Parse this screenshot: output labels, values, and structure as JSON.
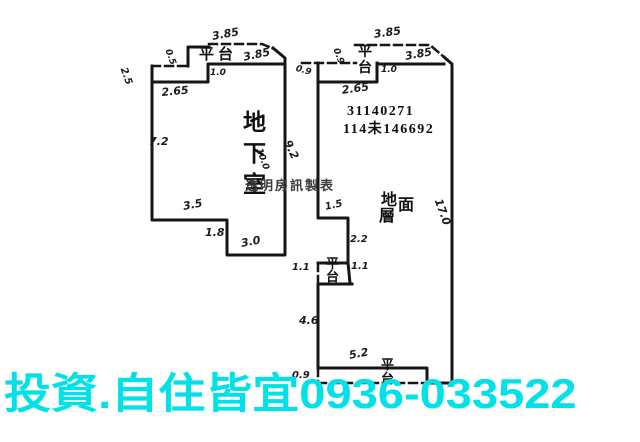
{
  "canvas": {
    "background": "#ffffff",
    "ink_color": "#161616"
  },
  "watermark": {
    "text": "投資.自住皆宜0936-033522",
    "color": "#00e2e8"
  },
  "plan": {
    "left_building_room": "地下室",
    "right_building_room": "地面層",
    "registration_line1": "31140271",
    "registration_line2": "114未146692",
    "maker_credit": "透明房訊製表",
    "platform_label": "平台"
  },
  "annotations": [
    {
      "name": "dim-left-platform-top",
      "text": "3.85",
      "x": 211,
      "y": 30,
      "rot": -10,
      "kind": "dim"
    },
    {
      "name": "left-platform-label",
      "text": "平台",
      "x": 199,
      "y": 43,
      "kind": "room",
      "size": 15,
      "spacing": 4
    },
    {
      "name": "dim-left-top-edge",
      "text": "3.85",
      "x": 242,
      "y": 51,
      "rot": -12,
      "kind": "dim"
    },
    {
      "name": "dim-left-platform-side",
      "text": "0.5",
      "x": 172,
      "y": 48,
      "rot": 70,
      "kind": "dim",
      "size": 9
    },
    {
      "name": "dim-left-upper-left",
      "text": "2.5",
      "x": 128,
      "y": 66,
      "rot": 70,
      "kind": "dim",
      "size": 10
    },
    {
      "name": "dim-left-step",
      "text": "1.0",
      "x": 210,
      "y": 68,
      "kind": "dim",
      "size": 9
    },
    {
      "name": "dim-left-shoulder",
      "text": "2.65",
      "x": 161,
      "y": 86,
      "rot": -5,
      "kind": "dim"
    },
    {
      "name": "dim-left-west-wall",
      "text": "7.2",
      "x": 149,
      "y": 135,
      "kind": "dim"
    },
    {
      "name": "left-room-label",
      "text": "地下室",
      "x": 243,
      "y": 107,
      "dir": "v",
      "size": 23,
      "gap": 8,
      "kind": "room"
    },
    {
      "name": "dim-left-east-wall",
      "text": "10.0",
      "x": 263,
      "y": 147,
      "rot": 70,
      "kind": "dim",
      "size": 9
    },
    {
      "name": "dim-left-bottom-upper",
      "text": "3.5",
      "x": 182,
      "y": 200,
      "rot": -10,
      "kind": "dim"
    },
    {
      "name": "dim-left-bottom-step",
      "text": "1.8",
      "x": 205,
      "y": 226,
      "kind": "dim"
    },
    {
      "name": "dim-left-bottom-lower",
      "text": "3.0",
      "x": 240,
      "y": 237,
      "rot": -10,
      "kind": "dim"
    },
    {
      "name": "maker-credit",
      "text": "透明房訊製表",
      "x": 245,
      "y": 175,
      "kind": "credit"
    },
    {
      "name": "dim-right-platform-top",
      "text": "3.85",
      "x": 373,
      "y": 28,
      "rot": -8,
      "kind": "dim"
    },
    {
      "name": "right-platform-top-label",
      "text": "平台",
      "x": 358,
      "y": 45,
      "dir": "v",
      "size": 14,
      "gap": 2,
      "kind": "room"
    },
    {
      "name": "dim-right-platform-side",
      "text": "0.9",
      "x": 340,
      "y": 47,
      "rot": 70,
      "kind": "dim",
      "size": 9
    },
    {
      "name": "dim-right-top-edge",
      "text": "3.85",
      "x": 404,
      "y": 50,
      "rot": -10,
      "kind": "dim"
    },
    {
      "name": "dim-right-upper-left",
      "text": "0.9",
      "x": 297,
      "y": 64,
      "rot": 15,
      "kind": "dim",
      "size": 9
    },
    {
      "name": "dim-right-step",
      "text": "1.0",
      "x": 381,
      "y": 65,
      "kind": "dim",
      "size": 9
    },
    {
      "name": "dim-right-shoulder",
      "text": "2.65",
      "x": 341,
      "y": 84,
      "rot": -8,
      "kind": "dim"
    },
    {
      "name": "registration-number-line1",
      "text": "31140271",
      "x": 347,
      "y": 104,
      "kind": "stamp"
    },
    {
      "name": "registration-number-line2",
      "text": "114未146692",
      "x": 343,
      "y": 118,
      "kind": "stamp"
    },
    {
      "name": "dim-right-west-upper",
      "text": "9.2",
      "x": 293,
      "y": 138,
      "rot": 65,
      "kind": "dim"
    },
    {
      "name": "right-room-label",
      "text": "地面層",
      "x": 381,
      "y": 186,
      "kind": "room",
      "size": 16,
      "cluster": [
        [
          0,
          0
        ],
        [
          17,
          5
        ],
        [
          -2,
          16
        ]
      ]
    },
    {
      "name": "dim-right-jog",
      "text": "1.5",
      "x": 324,
      "y": 202,
      "rot": -12,
      "kind": "dim",
      "size": 10
    },
    {
      "name": "dim-right-mid",
      "text": "2.2",
      "x": 350,
      "y": 234,
      "kind": "dim",
      "size": 10
    },
    {
      "name": "dim-right-notch-left",
      "text": "1.1",
      "x": 292,
      "y": 262,
      "kind": "dim",
      "size": 10
    },
    {
      "name": "right-platform-mid-label",
      "text": "平台",
      "x": 326,
      "y": 257,
      "dir": "v",
      "size": 13,
      "gap": 0,
      "kind": "room"
    },
    {
      "name": "dim-right-notch-right",
      "text": "1.1",
      "x": 351,
      "y": 261,
      "kind": "dim",
      "size": 10
    },
    {
      "name": "dim-right-west-lower",
      "text": "4.6",
      "x": 299,
      "y": 314,
      "kind": "dim"
    },
    {
      "name": "dim-right-bottom-edge",
      "text": "5.2",
      "x": 348,
      "y": 349,
      "rot": -10,
      "kind": "dim"
    },
    {
      "name": "right-platform-bottom-label",
      "text": "平台",
      "x": 381,
      "y": 358,
      "dir": "v",
      "size": 13,
      "gap": 1,
      "kind": "room"
    },
    {
      "name": "dim-right-bottom-platform",
      "text": "0.9",
      "x": 292,
      "y": 370,
      "kind": "dim",
      "size": 10
    },
    {
      "name": "dim-right-east-wall",
      "text": "17.0",
      "x": 444,
      "y": 197,
      "rot": 70,
      "kind": "dim"
    }
  ]
}
